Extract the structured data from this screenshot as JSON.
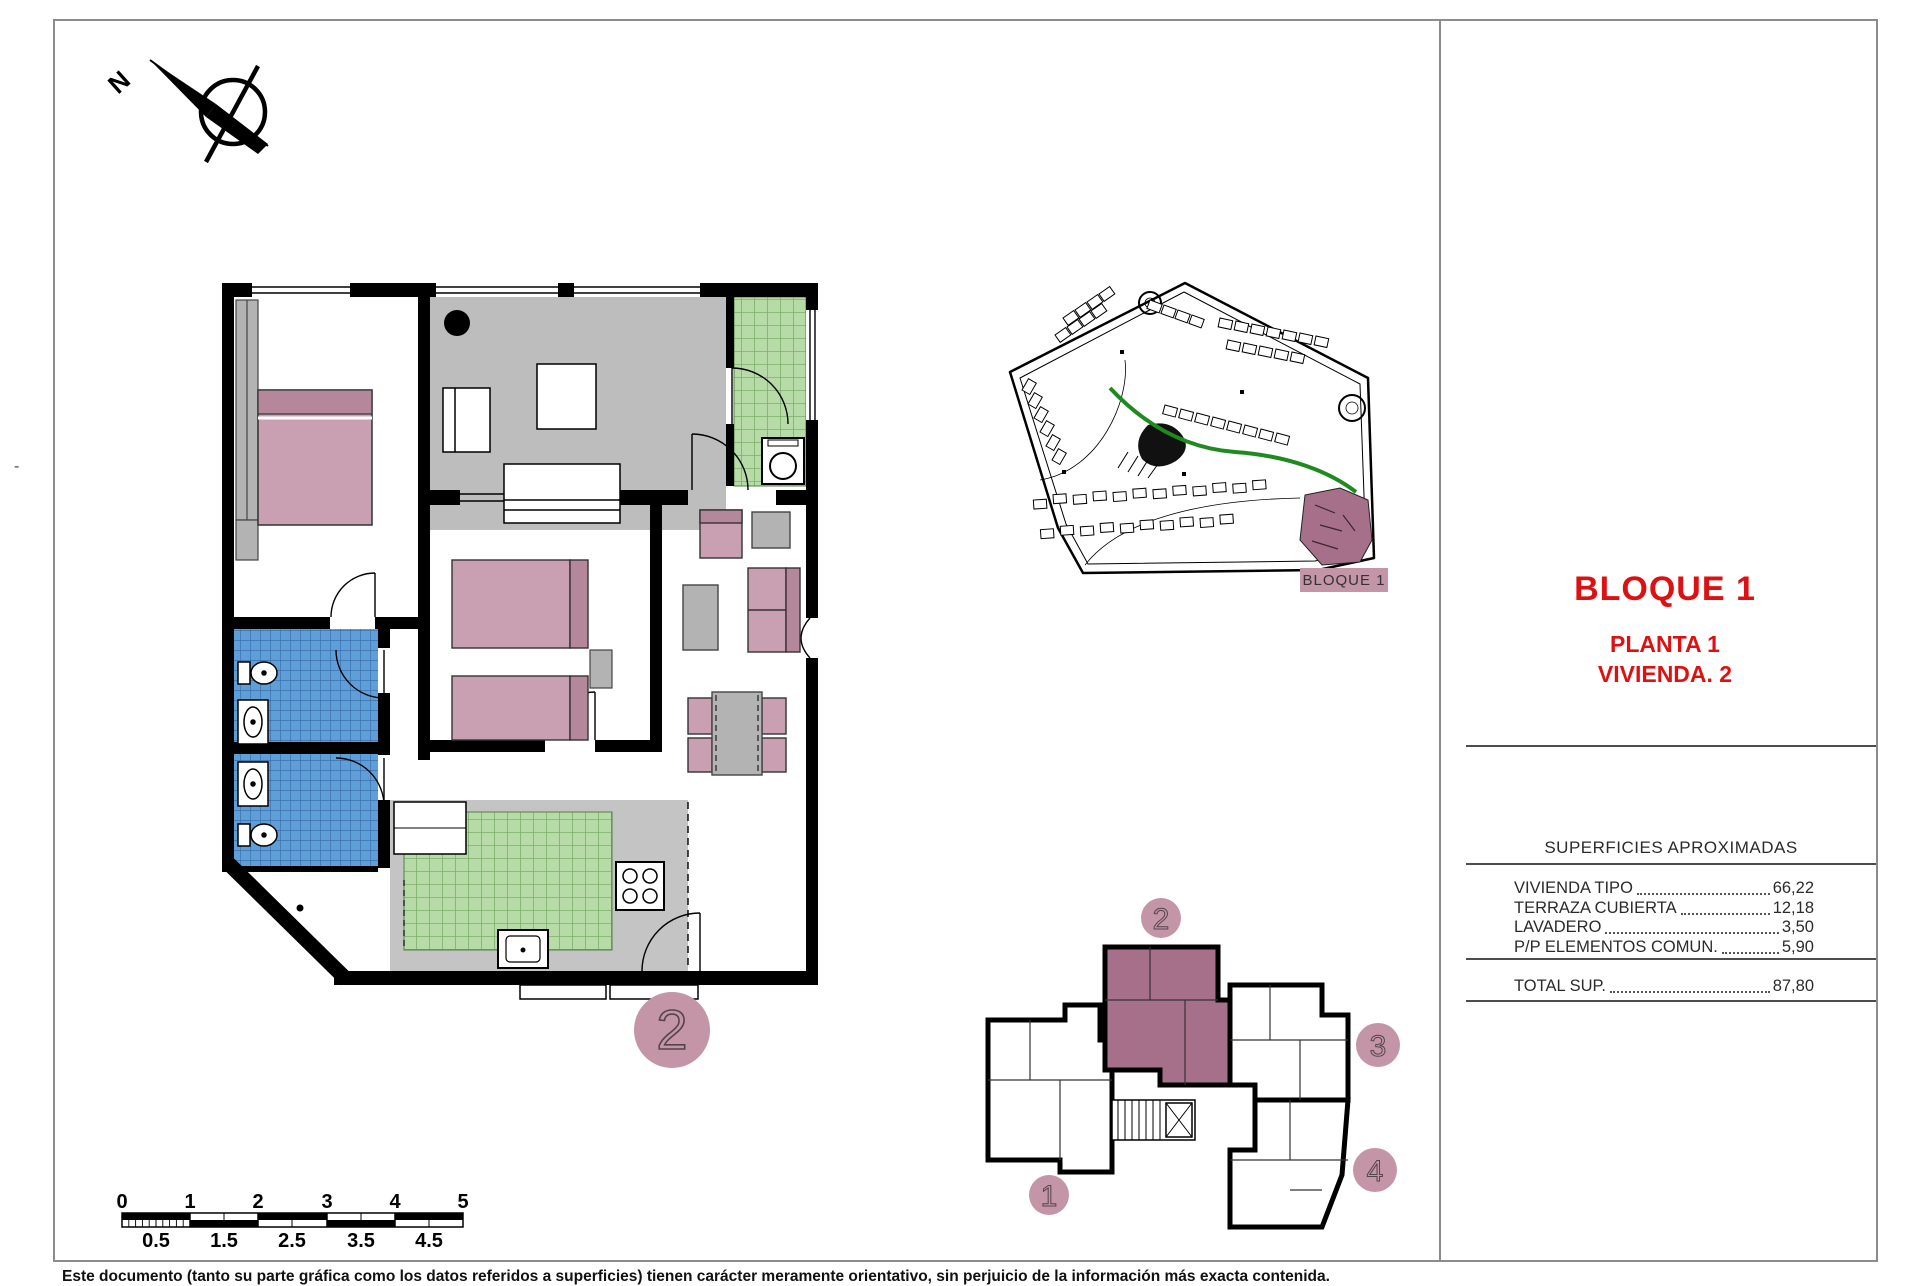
{
  "titles": {
    "bloque": "BLOQUE 1",
    "planta": "PLANTA 1",
    "vivienda": "VIVIENDA. 2"
  },
  "surfaces": {
    "header": "SUPERFICIES APROXIMADAS",
    "rows": [
      {
        "label": "VIVIENDA TIPO",
        "value": "66,22"
      },
      {
        "label": "TERRAZA CUBIERTA",
        "value": "12,18"
      },
      {
        "label": "LAVADERO",
        "value": "3,50"
      },
      {
        "label": "P/P ELEMENTOS COMUN.",
        "value": "5,90"
      }
    ],
    "total": {
      "label": "TOTAL SUP.",
      "value": "87,80"
    }
  },
  "site_plan": {
    "highlight_label": "BLOQUE 1"
  },
  "key_plan": {
    "badges": [
      "1",
      "2",
      "3",
      "4"
    ],
    "highlighted_unit": "2"
  },
  "floor_plan": {
    "unit_badge": "2"
  },
  "compass": {
    "north_label": "N"
  },
  "scale_bar": {
    "major": [
      "0",
      "1",
      "2",
      "3",
      "4",
      "5"
    ],
    "minor": [
      "0.5",
      "1.5",
      "2.5",
      "3.5",
      "4.5"
    ]
  },
  "page": {
    "margin_mark": "-"
  },
  "disclaimer": "Este documento (tanto su parte gráfica como los datos referidos a superficies) tienen carácter meramente orientativo, sin perjuicio de la información más exacta contenida.",
  "colors": {
    "accent_red": "#dd1111",
    "mauve_light": "#c495a7",
    "mauve_dark": "#a7708a",
    "furniture_mauve": "#c8a0b2",
    "tile_green": "#b7dba7",
    "tile_blue": "#5f9fd8",
    "floor_gray": "#bdbdbd",
    "frame_gray": "#8c8c8c"
  }
}
